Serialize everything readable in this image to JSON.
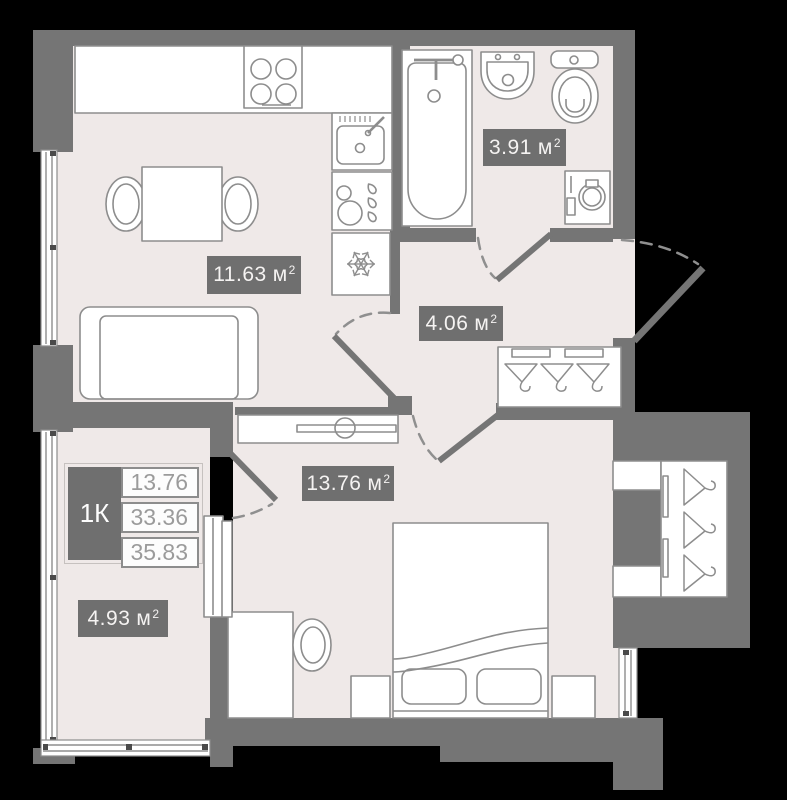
{
  "rooms": {
    "kitchen_living": {
      "area": "11.63",
      "unit": "м",
      "sup": "2"
    },
    "bathroom": {
      "area": "3.91",
      "unit": "м",
      "sup": "2"
    },
    "hallway": {
      "area": "4.06",
      "unit": "м",
      "sup": "2"
    },
    "bedroom": {
      "area": "13.76",
      "unit": "м",
      "sup": "2"
    },
    "balcony": {
      "area": "4.93",
      "unit": "м",
      "sup": "2"
    }
  },
  "summary_table": {
    "unit_type": "1К",
    "rows": [
      "13.76",
      "33.36",
      "35.83"
    ]
  },
  "fixtures": [
    "stove-icon",
    "kitchen-sink-icon",
    "dishwasher-icon",
    "refrigerator-snowflake-icon",
    "dining-table",
    "dining-chair",
    "sofa",
    "bathtub-icon",
    "washbasin-icon",
    "toilet-icon",
    "washing-machine-icon",
    "hanger-icon",
    "shelf",
    "tv-stand",
    "desk",
    "desk-chair",
    "double-bed",
    "pillow",
    "nightstand",
    "wardrobe",
    "balcony-door-unit",
    "door-swing-arc"
  ],
  "colors": {
    "background": "#000000",
    "wall": "#757575",
    "floor": "#efe9e8",
    "furniture_stroke": "#8d8d8d",
    "label_bg": "#6f6f6f",
    "label_text": "#f5f3f2",
    "table_value_text": "#9b9b9b",
    "table_border": "#8d8d8d"
  }
}
